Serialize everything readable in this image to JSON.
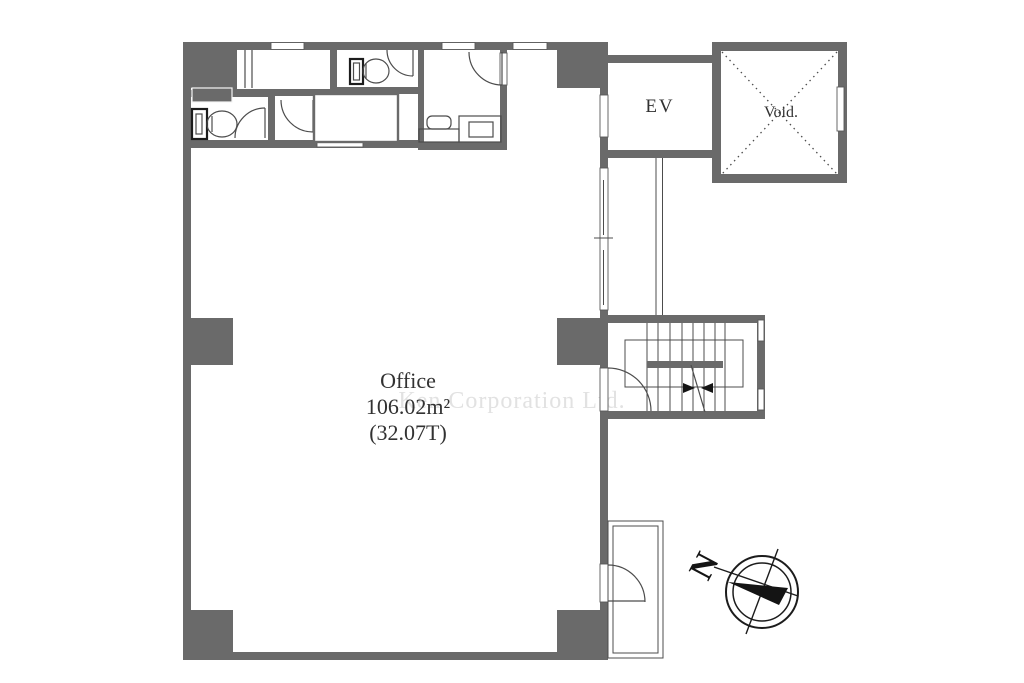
{
  "watermark": {
    "text": "Ken Corporation Ltd."
  },
  "rooms": {
    "office": {
      "label": "Office",
      "area_m2": "106.02m²",
      "area_tsubo": "(32.07T)"
    },
    "elevator": {
      "label": "EV"
    },
    "void": {
      "label": "Void."
    }
  },
  "compass": {
    "north_label": "N"
  },
  "colors": {
    "wall": "#6a6a6a",
    "line": "#4c4c4c",
    "dark": "#141414",
    "text": "#323232",
    "watermark": "#e2e2e2",
    "background": "#ffffff"
  }
}
